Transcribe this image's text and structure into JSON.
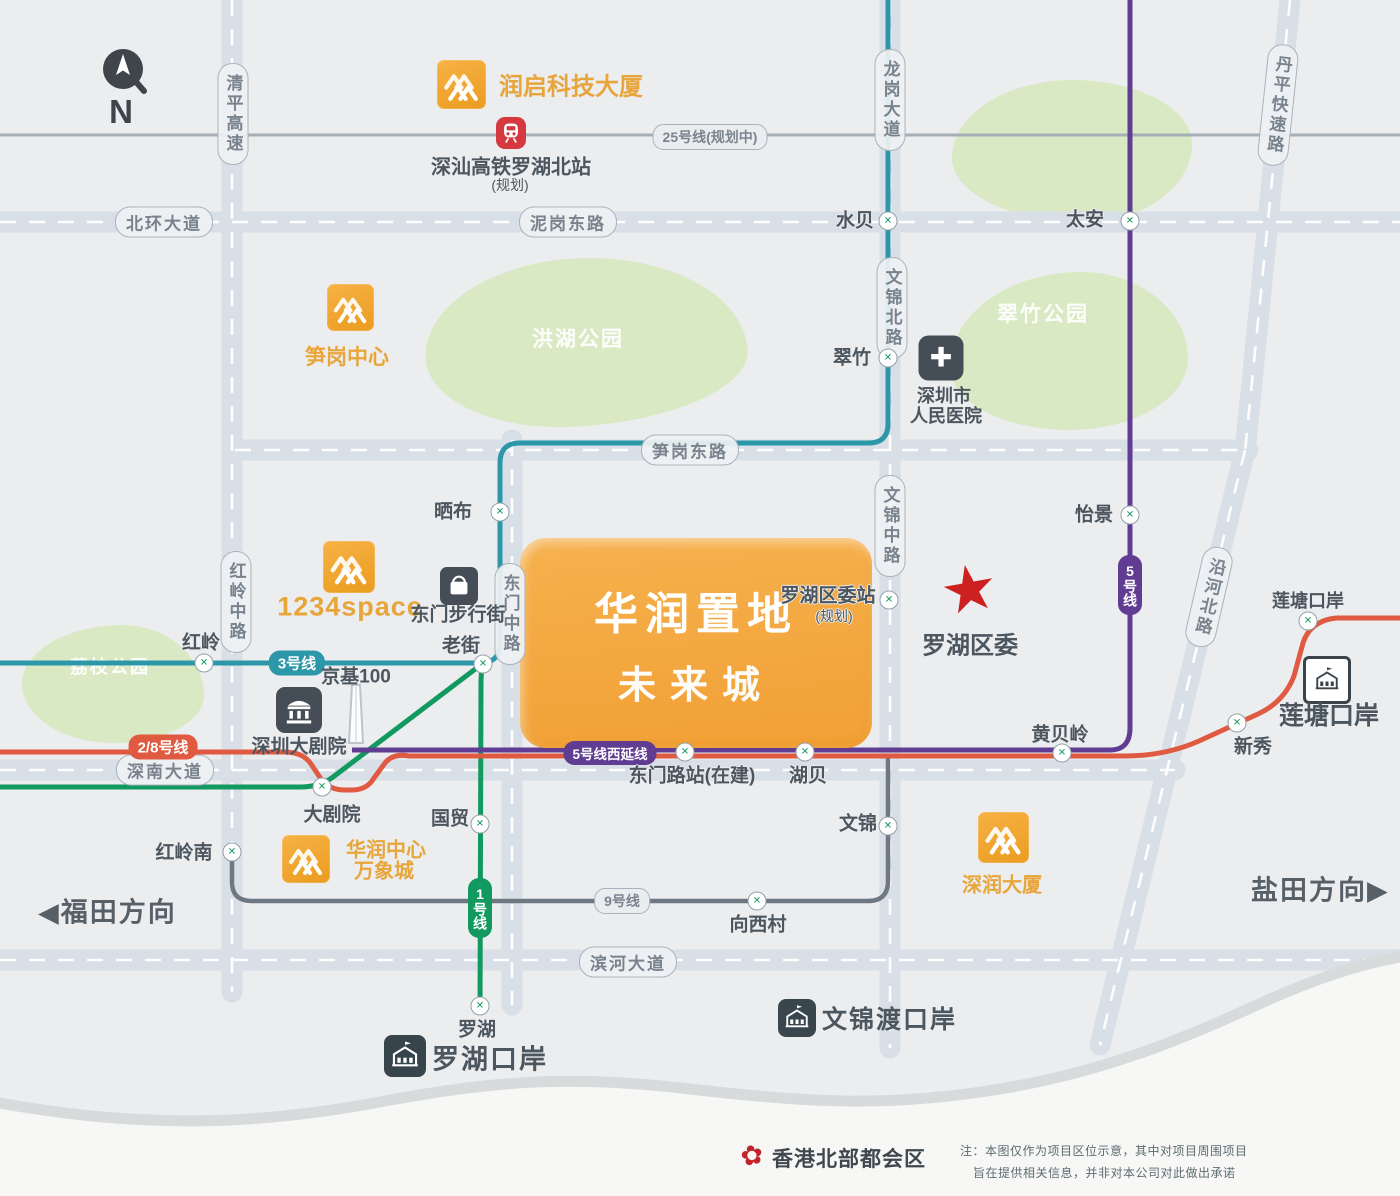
{
  "colors": {
    "park": "#d9e9c3",
    "line1": "#12995f",
    "line28": "#e05a41",
    "line3": "#2b97a8",
    "line5": "#603d92",
    "line9": "#6d7882",
    "line25": "#a6aeb6",
    "block-orange": "#f4a83d",
    "cr-orange": "#efa22e",
    "orange-text": "#e7a53a",
    "star-red": "#cd2121",
    "rail-red": "#d5383f",
    "dark-icon": "#454e57",
    "road-fill": "#d9dfe7",
    "label-text": "#4c565f",
    "road-text": "#79838d"
  },
  "compass": {
    "n": "N"
  },
  "project": {
    "line1": "华润置地",
    "line2": "未来城"
  },
  "roads": [
    {
      "label": "清平高速"
    },
    {
      "label": "北环大道"
    },
    {
      "label": "泥岗东路"
    },
    {
      "label": "龙岗大道"
    },
    {
      "label": "丹平快速路"
    },
    {
      "label": "笋岗东路"
    },
    {
      "label": "红岭中路"
    },
    {
      "label": "东门中路"
    },
    {
      "label": "文锦北路"
    },
    {
      "label": "文锦中路"
    },
    {
      "label": "沿河北路"
    },
    {
      "label": "深南大道"
    },
    {
      "label": "滨河大道"
    }
  ],
  "lines": [
    {
      "label": "25号线(规划中)"
    },
    {
      "label": "3号线"
    },
    {
      "label": "2/8号线"
    },
    {
      "label": "5号线西延线"
    },
    {
      "label": "9号线"
    },
    {
      "label": "1号线"
    },
    {
      "label": "5号线"
    }
  ],
  "stations": [
    {
      "name": "水贝"
    },
    {
      "name": "太安"
    },
    {
      "name": "翠竹"
    },
    {
      "name": "晒布"
    },
    {
      "name": "老街"
    },
    {
      "name": "红岭"
    },
    {
      "name": "大剧院"
    },
    {
      "name": "红岭南"
    },
    {
      "name": "国贸"
    },
    {
      "name": "罗湖"
    },
    {
      "name": "东门路站(在建)"
    },
    {
      "name": "湖贝"
    },
    {
      "name": "文锦"
    },
    {
      "name": "黄贝岭"
    },
    {
      "name": "新秀"
    },
    {
      "name": "莲塘口岸"
    },
    {
      "name": "怡景"
    },
    {
      "name": "罗湖区委站",
      "sub": "(规划)"
    },
    {
      "name": "向西村"
    }
  ],
  "parks": [
    {
      "name": "洪湖公园"
    },
    {
      "name": "翠竹公园"
    },
    {
      "name": "荔枝公园"
    }
  ],
  "cr_landmarks": [
    {
      "name": "润启科技大厦"
    },
    {
      "name": "笋岗中心"
    },
    {
      "name": "1234space"
    },
    {
      "line1": "华润中心",
      "line2": "万象城"
    },
    {
      "name": "深润大厦"
    }
  ],
  "poi": {
    "rail_station": {
      "name": "深汕高铁罗湖北站",
      "sub": "(规划)"
    },
    "hospital": {
      "line1": "深圳市",
      "line2": "人民医院"
    },
    "pedestrian_street": {
      "name": "东门步行街"
    },
    "kk100": {
      "name": "京基100"
    },
    "theater": {
      "name": "深圳大剧院"
    },
    "district_committee": {
      "name": "罗湖区委"
    }
  },
  "ports": [
    {
      "name": "罗湖口岸"
    },
    {
      "name": "文锦渡口岸"
    },
    {
      "name": "莲塘口岸"
    }
  ],
  "directions": {
    "west": {
      "arrow": "◀",
      "label": "福田方向"
    },
    "east": {
      "label": "盐田方向",
      "arrow": "▶"
    }
  },
  "footer": {
    "hk": "香港北部都会区",
    "note1": "注：本图仅作为项目区位示意，其中对项目周围项目",
    "note2": "旨在提供相关信息，并非对本公司对此做出承诺"
  }
}
